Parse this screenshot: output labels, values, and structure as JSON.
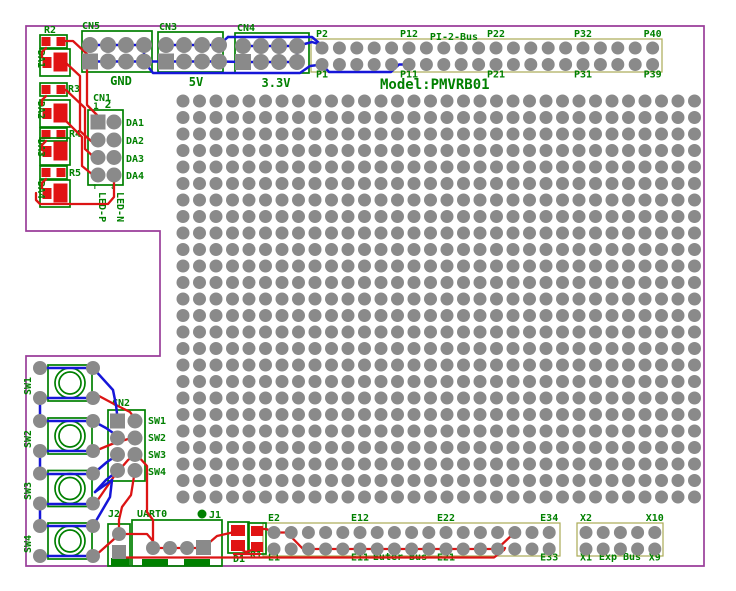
{
  "title_text": "Model:PMVRB01",
  "colors": {
    "board_outline": "#993d99",
    "silkscreen_green": "#008000",
    "pad_gray": "#8a8a8a",
    "trace_top_red": "#dc1414",
    "trace_bottom_blue": "#1616d8",
    "bus_box_olive": "#aaaa55",
    "smd_red": "#e11414",
    "background": "#ffffff"
  },
  "top_headers": [
    {
      "ref": "CN5",
      "net": "GND"
    },
    {
      "ref": "CN3",
      "net": "5V"
    },
    {
      "ref": "CN4",
      "net": "3.3V"
    }
  ],
  "cn1": {
    "ref": "CN1",
    "pin1": "1",
    "pin2": "2",
    "rows": [
      "DA1",
      "DA2",
      "DA3",
      "DA4"
    ],
    "led_p": "LED-P",
    "led_n": "LED-N",
    "arrow_up": "↑",
    "arrow_down": "↓"
  },
  "left_parts": {
    "resistors": [
      "R2",
      "R3",
      "R4",
      "R5"
    ],
    "leds": [
      "DA1",
      "DA2",
      "DA3",
      "DA4"
    ]
  },
  "switch_refs": [
    "SW1",
    "SW2",
    "SW3",
    "SW4"
  ],
  "cn2": {
    "ref": "CN2",
    "rows": [
      "SW1",
      "SW2",
      "SW3",
      "SW4"
    ]
  },
  "bottom_parts": {
    "j2": "J2",
    "uart": "UART0",
    "j1": "J1",
    "d1": "D1",
    "r1": "R1"
  },
  "p_bus": {
    "box_label": "PI-2-Bus",
    "cols": 20,
    "rows": 2,
    "top_labels": [
      {
        "text": "P2",
        "col": 1
      },
      {
        "text": "P12",
        "col": 6
      },
      {
        "text": "P22",
        "col": 11
      },
      {
        "text": "P32",
        "col": 16
      },
      {
        "text": "P40",
        "col": 20
      }
    ],
    "bottom_labels": [
      {
        "text": "P1",
        "col": 1
      },
      {
        "text": "P11",
        "col": 6
      },
      {
        "text": "P21",
        "col": 11
      },
      {
        "text": "P31",
        "col": 16
      },
      {
        "text": "P39",
        "col": 20
      }
    ]
  },
  "e_bus": {
    "box_label": "Euter Bus",
    "cols": 17,
    "rows": 2,
    "top_labels": [
      {
        "text": "E2",
        "col": 1
      },
      {
        "text": "E12",
        "col": 6
      },
      {
        "text": "E22",
        "col": 11
      },
      {
        "text": "E34",
        "col": 17
      }
    ],
    "bottom_labels": [
      {
        "text": "E1",
        "col": 1
      },
      {
        "text": "E11",
        "col": 6
      },
      {
        "text": "E21",
        "col": 11
      },
      {
        "text": "E33",
        "col": 17
      }
    ]
  },
  "x_bus": {
    "box_label": "Exp Bus",
    "cols": 5,
    "rows": 2,
    "top_labels": [
      {
        "text": "X2",
        "col": 1
      },
      {
        "text": "X10",
        "col": 5
      }
    ],
    "bottom_labels": [
      {
        "text": "X1",
        "col": 1
      },
      {
        "text": "X9",
        "col": 5
      }
    ]
  },
  "proto_grid": {
    "cols": 32,
    "rows": 25
  }
}
